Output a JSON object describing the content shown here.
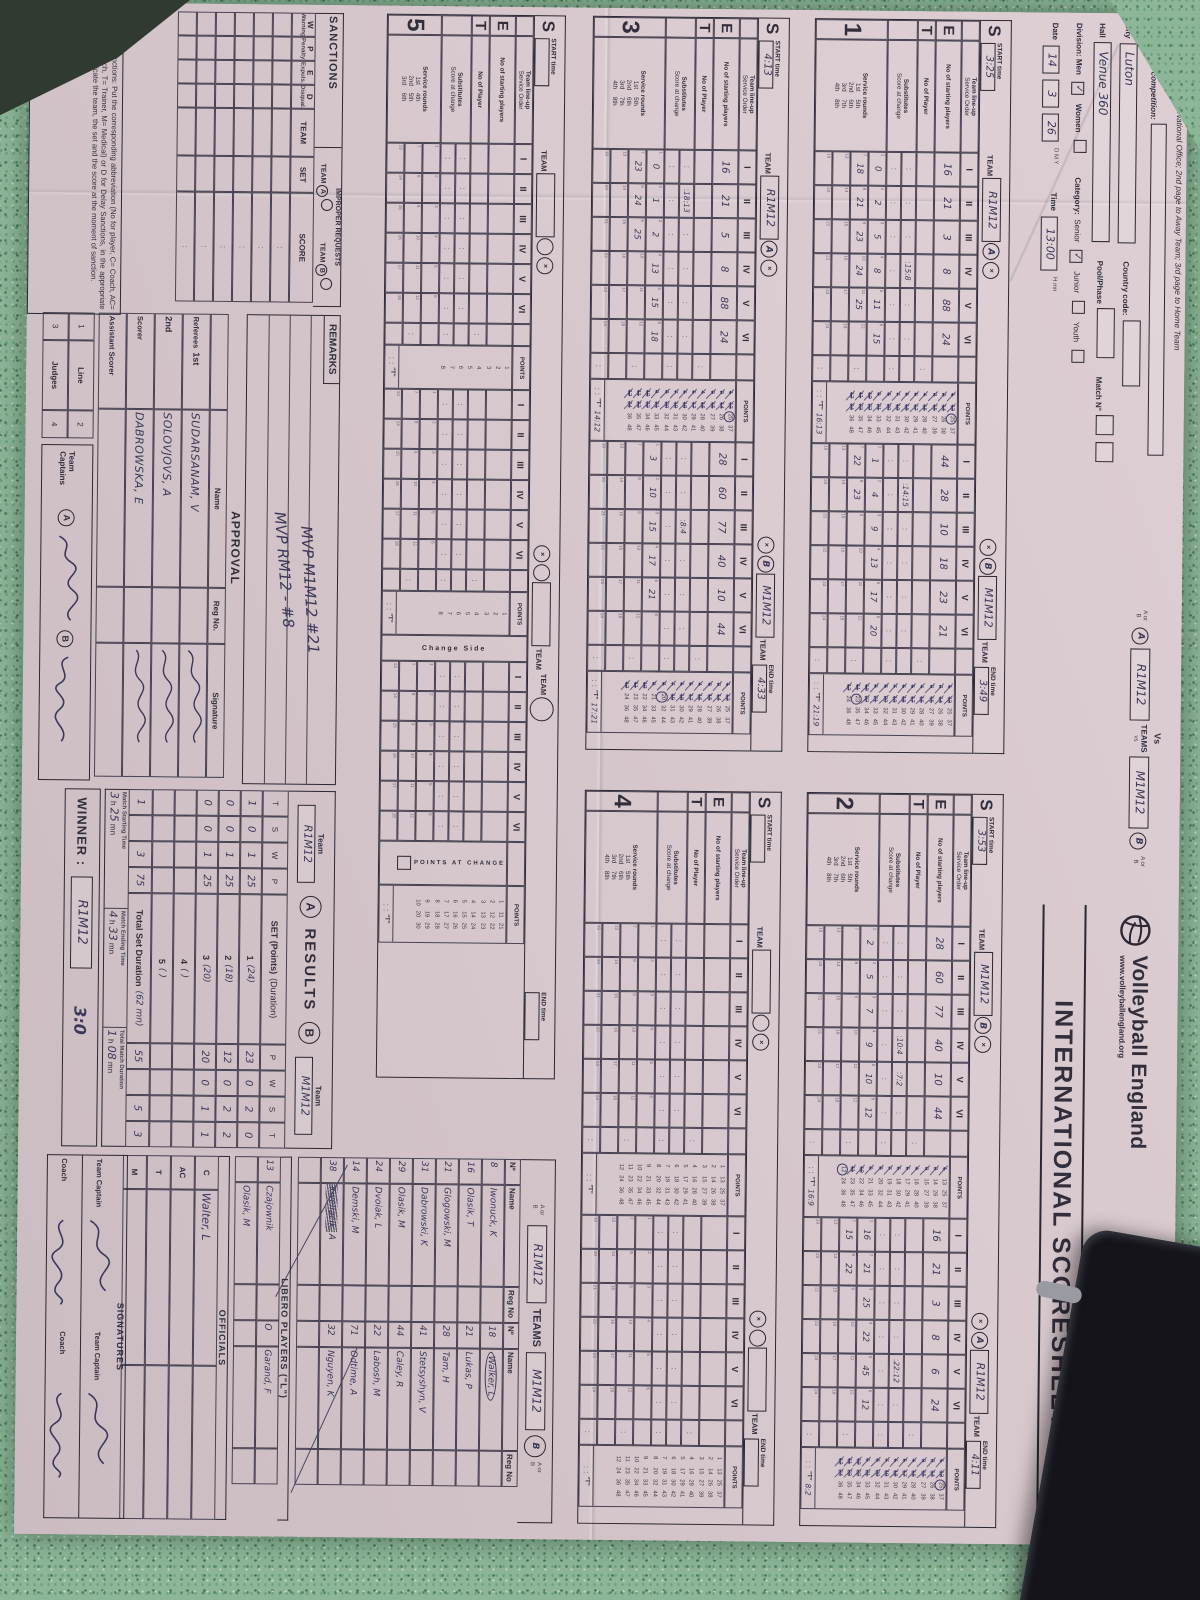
{
  "colors": {
    "paper": "#d6c7cc",
    "print_ink": "#2c2733",
    "pen_ink": "#3c3858",
    "table_felt": "#8db699"
  },
  "header": {
    "distribution": "Distribution: 1st page to National Office; 2nd page to Away Team; 3rd page to Home Team",
    "competition_label": "Name of the competition:",
    "city_label": "City",
    "city_value": "Luton",
    "hall_label": "Hall",
    "hall_value": "Venue 360",
    "country_code_label": "Country code:",
    "pool_phase_label": "Pool/Phase",
    "match_no_label": "Match N°",
    "division_label": "Division: Men",
    "women_label": "Women",
    "men_tick": "✓",
    "category_label": "Category:",
    "senior_label": "Senior",
    "junior_label": "Junior",
    "youth_label": "Youth",
    "senior_tick": "✓",
    "date_label": "Date",
    "date_d": "14",
    "date_m": "3",
    "date_y": "26",
    "dmy": "D    M    Y",
    "time_label": "Time",
    "time_value": "13:00",
    "hmn": "H    mn",
    "vs": {
      "vs_label": "Vs",
      "aorb": "A or B",
      "circle_a": "A",
      "team_a": "R1M12",
      "teams_label": "TEAMS",
      "vs_small": "vs",
      "team_b": "M1M12",
      "circle_b": "B"
    },
    "brand": {
      "name": "Volleyball England",
      "url": "www.volleyballengland.org",
      "title": "INTERNATIONAL SCORESHEET",
      "fivb": "FIVB."
    }
  },
  "set_labels": {
    "team_lineup": "Team line-up",
    "service_order": "Service Order",
    "starting": "No of starting players",
    "no_of_player": "No of Player",
    "subs": "Substitutes",
    "score_at_change": "Score at change",
    "service_rounds": "Service rounds",
    "start_label": "START time",
    "end_label": "END time",
    "hmn": "H  mn",
    "team_label": "TEAM",
    "points_label": "POINTS",
    "pac_label": "POINTS AT CHANGE",
    "change_side": "Change Side",
    "t_label": "\"T\"",
    "numerals": [
      "I",
      "II",
      "III",
      "IV",
      "V",
      "VI"
    ],
    "ordinals": [
      [
        "1st",
        "5th"
      ],
      [
        "2nd",
        "6th"
      ],
      [
        "3rd",
        "7th"
      ],
      [
        "4th",
        "8th"
      ]
    ],
    "ordinals5": [
      [
        "1st",
        "4th"
      ],
      [
        "2nd",
        "5th"
      ],
      [
        "3rd",
        "6th"
      ]
    ]
  },
  "sets": [
    {
      "no": "1",
      "start": "3:25",
      "end": "3:49",
      "left": {
        "team": "R1M12",
        "letter": "A",
        "players": [
          "16",
          "21",
          "3",
          "8",
          "88",
          "24"
        ],
        "score": 25,
        "subs": [
          "",
          "",
          "",
          "15:8",
          "",
          ""
        ],
        "rounds": [
          "0",
          "2",
          "5",
          "8",
          "11",
          "15",
          "18",
          "21",
          "23",
          "24",
          "25",
          ""
        ],
        "t": "16:13"
      },
      "right": {
        "team": "M1M12",
        "letter": "B",
        "players": [
          "44",
          "28",
          "10",
          "18",
          "23",
          "21"
        ],
        "score": 23,
        "subs": [
          "",
          "14:15",
          "",
          "",
          "",
          ""
        ],
        "rounds": [
          "1",
          "4",
          "9",
          "13",
          "17",
          "20",
          "22",
          "23",
          "",
          "",
          "",
          ""
        ],
        "t": "21:19"
      }
    },
    {
      "no": "2",
      "start": "3:53",
      "end": "4:11",
      "left": {
        "team": "M1M12",
        "letter": "B",
        "players": [
          "28",
          "60",
          "77",
          "40",
          "10",
          "44"
        ],
        "score": 12,
        "subs": [
          "",
          "",
          "",
          "10:4",
          "7:2",
          ""
        ],
        "rounds": [
          "2",
          "5",
          "7",
          "9",
          "10",
          "12",
          "",
          "",
          "",
          "",
          "",
          ""
        ],
        "t": "16:9"
      },
      "right": {
        "team": "R1M12",
        "letter": "A",
        "players": [
          "16",
          "21",
          "3",
          "8",
          "6",
          "24"
        ],
        "score": 25,
        "subs": [
          "",
          "",
          "",
          "",
          "22:12",
          ""
        ],
        "rounds": [
          "16",
          "21",
          "25",
          "22",
          "45",
          "12",
          "15",
          "22",
          "",
          "",
          "",
          ""
        ],
        "t": "8:2"
      }
    },
    {
      "no": "3",
      "start": "4:13",
      "end": "4:33",
      "left": {
        "team": "R1M12",
        "letter": "A",
        "players": [
          "16",
          "21",
          "5",
          "8",
          "88",
          "24"
        ],
        "score": 25,
        "subs": [
          "",
          "18:13",
          "",
          "",
          "",
          ""
        ],
        "rounds": [
          "0",
          "1",
          "2",
          "13",
          "15",
          "18",
          "23",
          "24",
          "25",
          "",
          "",
          ""
        ],
        "t": "14:12"
      },
      "right": {
        "team": "M1M12",
        "letter": "B",
        "players": [
          "28",
          "60",
          "77",
          "40",
          "10",
          "44"
        ],
        "score": 20,
        "subs": [
          "",
          "",
          "8:4",
          "",
          "",
          ""
        ],
        "rounds": [
          "3",
          "10",
          "15",
          "17",
          "21",
          "",
          "",
          "",
          "",
          "",
          "",
          ""
        ],
        "t": "17:21"
      }
    },
    {
      "no": "4",
      "start": "",
      "end": "",
      "left": {
        "team": "",
        "letter": "",
        "players": [
          "",
          "",
          "",
          "",
          "",
          ""
        ],
        "score": 0,
        "subs": [
          "",
          "",
          "",
          "",
          "",
          ""
        ],
        "rounds": [],
        "t": ""
      },
      "right": {
        "team": "",
        "letter": "",
        "players": [
          "",
          "",
          "",
          "",
          "",
          ""
        ],
        "score": 0,
        "subs": [
          "",
          "",
          "",
          "",
          "",
          ""
        ],
        "rounds": [],
        "t": ""
      }
    },
    {
      "no": "5",
      "start": "",
      "end": "",
      "left": {
        "team": "",
        "letter": "",
        "players": [
          "",
          "",
          "",
          "",
          "",
          ""
        ],
        "score": 0,
        "subs": [
          "",
          "",
          "",
          "",
          "",
          ""
        ],
        "rounds": [],
        "t": ""
      },
      "right": {
        "team": "",
        "letter": "",
        "players": [
          "",
          "",
          "",
          "",
          "",
          ""
        ],
        "score": 0,
        "subs": [
          "",
          "",
          "",
          "",
          "",
          ""
        ],
        "rounds": [],
        "t": ""
      }
    }
  ],
  "teams_section": {
    "title": "TEAMS",
    "aorb": "A or B",
    "team_a_box": "R1M12",
    "team_b_box": "M1M12",
    "circle_b": "B",
    "col_no": "Nº",
    "col_name": "Name",
    "col_reg": "Reg No",
    "roster_a": [
      [
        "8",
        "Iwonuck, K"
      ],
      [
        "16",
        "Olasik, T"
      ],
      [
        "21",
        "Glogowski, M"
      ],
      [
        "31",
        "Dabrowski, K"
      ],
      [
        "29",
        "Olasik, M"
      ],
      [
        "24",
        "Dvoiak, L"
      ],
      [
        "14",
        "Demski, M"
      ],
      [
        "38",
        "Kwellacik, A"
      ],
      [
        "",
        ""
      ]
    ],
    "roster_b": [
      [
        "18",
        "Walker, L"
      ],
      [
        "21",
        "Lukas, P"
      ],
      [
        "28",
        "Tam, H"
      ],
      [
        "41",
        "Stetsyshyn, V"
      ],
      [
        "44",
        "Caley, R"
      ],
      [
        "22",
        "Labosh, M"
      ],
      [
        "71",
        "Odtime, A"
      ],
      [
        "32",
        "Nguyen, K"
      ],
      [
        "",
        ""
      ]
    ]
  },
  "libero": {
    "title": "LIBERO PLAYERS (\"L\")",
    "rows": [
      [
        "13",
        "Czajownik",
        "O",
        "Garand, F"
      ],
      [
        "",
        "Olasik, M",
        "",
        ""
      ]
    ]
  },
  "officials": {
    "title": "OFFICIALS",
    "rows": [
      [
        "C",
        "Walter, L"
      ],
      [
        "AC",
        ""
      ],
      [
        "T",
        ""
      ],
      [
        "M",
        ""
      ]
    ]
  },
  "signatures": {
    "title": "SIGNATURES",
    "captain_label": "Team Captain",
    "coach_label": "Coach"
  },
  "results": {
    "title": "RESULTS",
    "team_label": "Team",
    "team_a": "R1M12",
    "team_b": "M1M12",
    "circle_a": "A",
    "circle_b": "B",
    "cols_left": [
      "T",
      "S",
      "W",
      "P"
    ],
    "points_note": "(Points)",
    "set_label": "SET",
    "duration_note": "(Duration)",
    "cols_right": [
      "P",
      "W",
      "S",
      "T"
    ],
    "rows": [
      {
        "left": [
          "1",
          "0",
          "1",
          "25"
        ],
        "set": "1",
        "dur": "(24)",
        "right": [
          "23",
          "0",
          "2",
          "0"
        ]
      },
      {
        "left": [
          "0",
          "0",
          "1",
          "25"
        ],
        "set": "2",
        "dur": "(18)",
        "right": [
          "12",
          "0",
          "2",
          "2"
        ]
      },
      {
        "left": [
          "0",
          "0",
          "1",
          "25"
        ],
        "set": "3",
        "dur": "(20)",
        "right": [
          "20",
          "0",
          "1",
          "1"
        ]
      },
      {
        "left": [
          "",
          "",
          "",
          ""
        ],
        "set": "4",
        "dur": "(    )",
        "right": [
          "",
          "",
          "",
          ""
        ]
      },
      {
        "left": [
          "",
          "",
          "",
          ""
        ],
        "set": "5",
        "dur": "(    )",
        "right": [
          "",
          "",
          "",
          ""
        ]
      }
    ],
    "totals": {
      "left": [
        "1",
        "",
        "3",
        "75"
      ],
      "label": "Total Set Duration",
      "dur": "(62 mn)",
      "right": [
        "55",
        "",
        "5",
        "3"
      ]
    },
    "match_start_label": "Match Starting Time",
    "match_start_h": "3",
    "match_start_m": "25",
    "match_end_label": "Match Ending Time",
    "match_end_h": "4",
    "match_end_m": "33",
    "match_dur_label": "Total Match Duration",
    "match_dur_h": "1",
    "match_dur_m": "08",
    "h_label": "h",
    "mn_label": "mn",
    "winner_label": "WINNER :",
    "winner": "R1M12",
    "winner_score": "3:0"
  },
  "sanctions": {
    "title": "SANCTIONS",
    "cols": [
      "W",
      "P",
      "E",
      "D"
    ],
    "col_notes": [
      "(Warning)",
      "(Penalty)",
      "(Expuls.)",
      "(Disqual.)"
    ],
    "team_col": "TEAM",
    "set_col": "SET",
    "score_col": "SCORE",
    "improper_title": "IMPROPER REQUESTS",
    "team_word": "TEAM",
    "rows": 6
  },
  "remarks": {
    "title": "REMARKS",
    "lines": [
      "MVP M1M12 #21",
      "MVP RM12 - #8"
    ]
  },
  "approval": {
    "title": "APPROVAL",
    "name_col": "Name",
    "reg_col": "Reg No.",
    "sig_col": "Signature",
    "rows": [
      [
        "Referees",
        "1st",
        "SUDARSANAM, V"
      ],
      [
        "",
        "2nd",
        "SOLOVJOVS, A"
      ],
      [
        "Scorer",
        "",
        "DABROWSKA, E"
      ],
      [
        "Assistant Scorer",
        "",
        ""
      ]
    ],
    "line_rows": [
      [
        "1",
        "Line",
        "2"
      ],
      [
        "3",
        "Judges",
        "4"
      ]
    ],
    "captains_label": "Team Captains",
    "circle_a": "A",
    "circle_b": "B"
  },
  "footnote": "To record sanctions: Put the corresponding abbreviation (No for player, C= Coach, AC= Assistant Coach, T= Trainer, M= Medical) or D for Delay Sanctions, in the appropriate column and indicate the team, the set and the score at the moment of sanction."
}
